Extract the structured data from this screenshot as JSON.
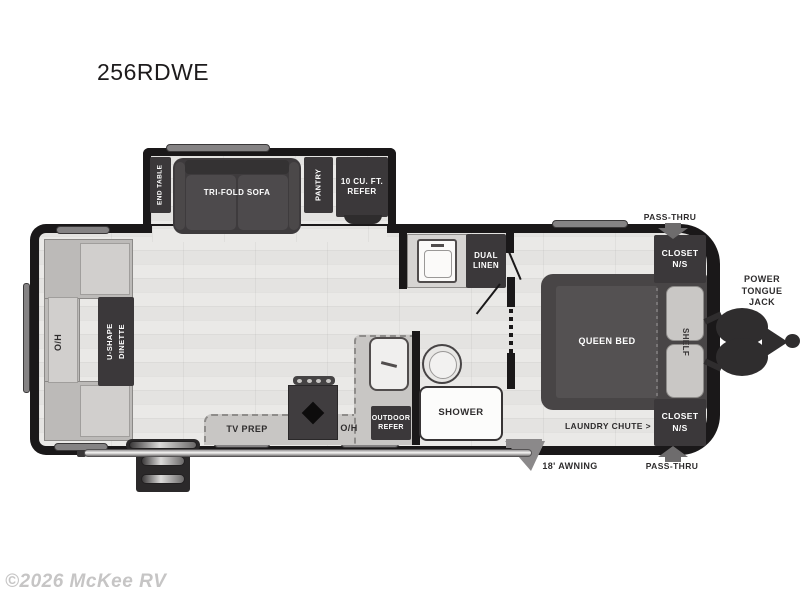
{
  "title": "256RDWE",
  "watermark": "©2026 McKee RV",
  "slideout": {
    "end_table": "END TABLE",
    "sofa": "TRI-FOLD SOFA",
    "pantry": "PANTRY",
    "refer": "10 CU. FT.\nREFER"
  },
  "dinette": {
    "overhead": "O/H",
    "table": "U-SHAPE\nDINETTE"
  },
  "kitchen": {
    "tv_prep": "TV PREP",
    "overhead": "O/H",
    "outdoor_refer": "OUTDOOR\nREFER"
  },
  "bath": {
    "dual_linen": "DUAL\nLINEN",
    "shower": "SHOWER"
  },
  "bedroom": {
    "bed": "QUEEN BED",
    "shelf": "SHELF",
    "closet_top": "CLOSET\nN/S",
    "closet_bottom": "CLOSET\nN/S",
    "laundry_chute": "LAUNDRY CHUTE >"
  },
  "exterior": {
    "pass_thru_top": "PASS-THRU",
    "pass_thru_bottom": "PASS-THRU",
    "tongue_jack": "POWER\nTONGUE\nJACK",
    "awning": "18' AWNING"
  },
  "colors": {
    "wall": "#1a1819",
    "floor": "#e7e5e3",
    "dark_fixture": "#3b383a",
    "light_fixture": "#c8c6c4",
    "trim_gray": "#858384",
    "arrow_gray": "#6e6c6d",
    "label_dark": "#2e2c2d",
    "label_light": "#ffffff"
  }
}
